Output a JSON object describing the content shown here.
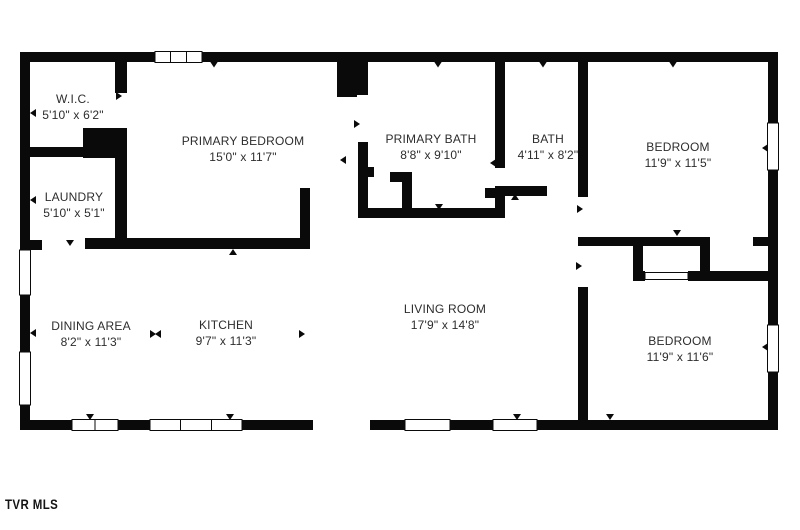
{
  "floorplan": {
    "watermark": "TVR MLS",
    "wall_color": "#0a0a0a",
    "background": "#ffffff",
    "rooms": [
      {
        "id": "wic",
        "name": "W.I.C.",
        "dims": "5'10\" x 6'2\""
      },
      {
        "id": "laundry",
        "name": "LAUNDRY",
        "dims": "5'10\" x 5'1\""
      },
      {
        "id": "primary-bedroom",
        "name": "PRIMARY BEDROOM",
        "dims": "15'0\" x 11'7\""
      },
      {
        "id": "primary-bath",
        "name": "PRIMARY BATH",
        "dims": "8'8\" x 9'10\""
      },
      {
        "id": "bath",
        "name": "BATH",
        "dims": "4'11\" x 8'2\""
      },
      {
        "id": "bedroom-top",
        "name": "BEDROOM",
        "dims": "11'9\" x 11'5\""
      },
      {
        "id": "dining-area",
        "name": "DINING AREA",
        "dims": "8'2\" x 11'3\""
      },
      {
        "id": "kitchen",
        "name": "KITCHEN",
        "dims": "9'7\" x 11'3\""
      },
      {
        "id": "living-room",
        "name": "LIVING ROOM",
        "dims": "17'9\" x 14'8\""
      },
      {
        "id": "bedroom-bottom",
        "name": "BEDROOM",
        "dims": "11'9\" x 11'6\""
      }
    ]
  }
}
